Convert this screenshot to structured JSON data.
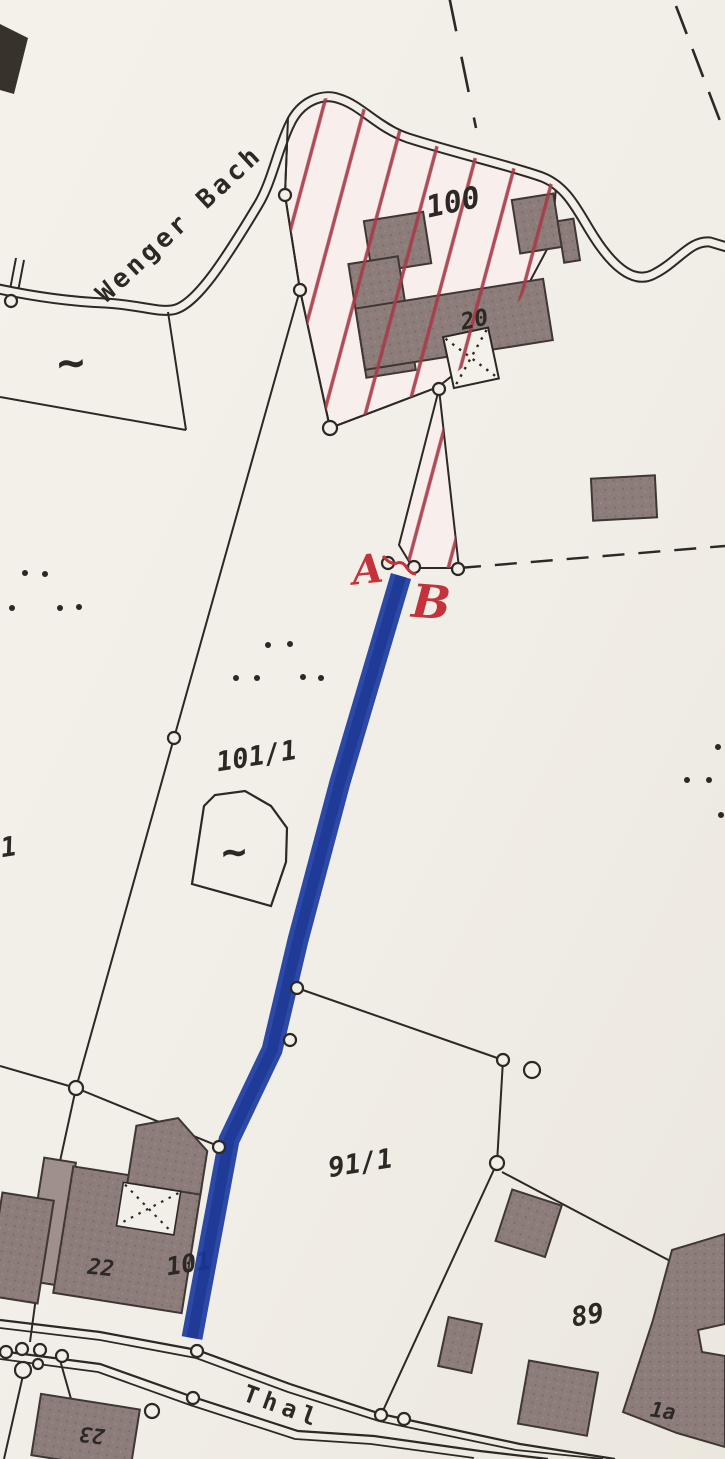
{
  "labels": {
    "stream": "Wenger Bach",
    "road": "Thal",
    "parcel_100": "100",
    "parcel_101_1": "101/1",
    "parcel_101": "101",
    "parcel_91_1": "91/1",
    "parcel_89": "89",
    "parcel_edge_1": "1",
    "house_20": "20",
    "house_22": "22",
    "house_23": "23",
    "house_1a": "1a",
    "point_a": "A",
    "point_b": "B",
    "wetland_symbol": "~"
  },
  "colors": {
    "paper": "#f2efe8",
    "ink": "#2c2824",
    "building_fill": "#8d7d7a",
    "hatch_red": "#a83a48",
    "annotation_red": "#c4323c",
    "highlight_blue": "#1d3c9f"
  },
  "icons": {
    "survey_point_marker": "open-circle",
    "meadow_dot": "dot",
    "open_structure_cross": "dotted-x"
  }
}
